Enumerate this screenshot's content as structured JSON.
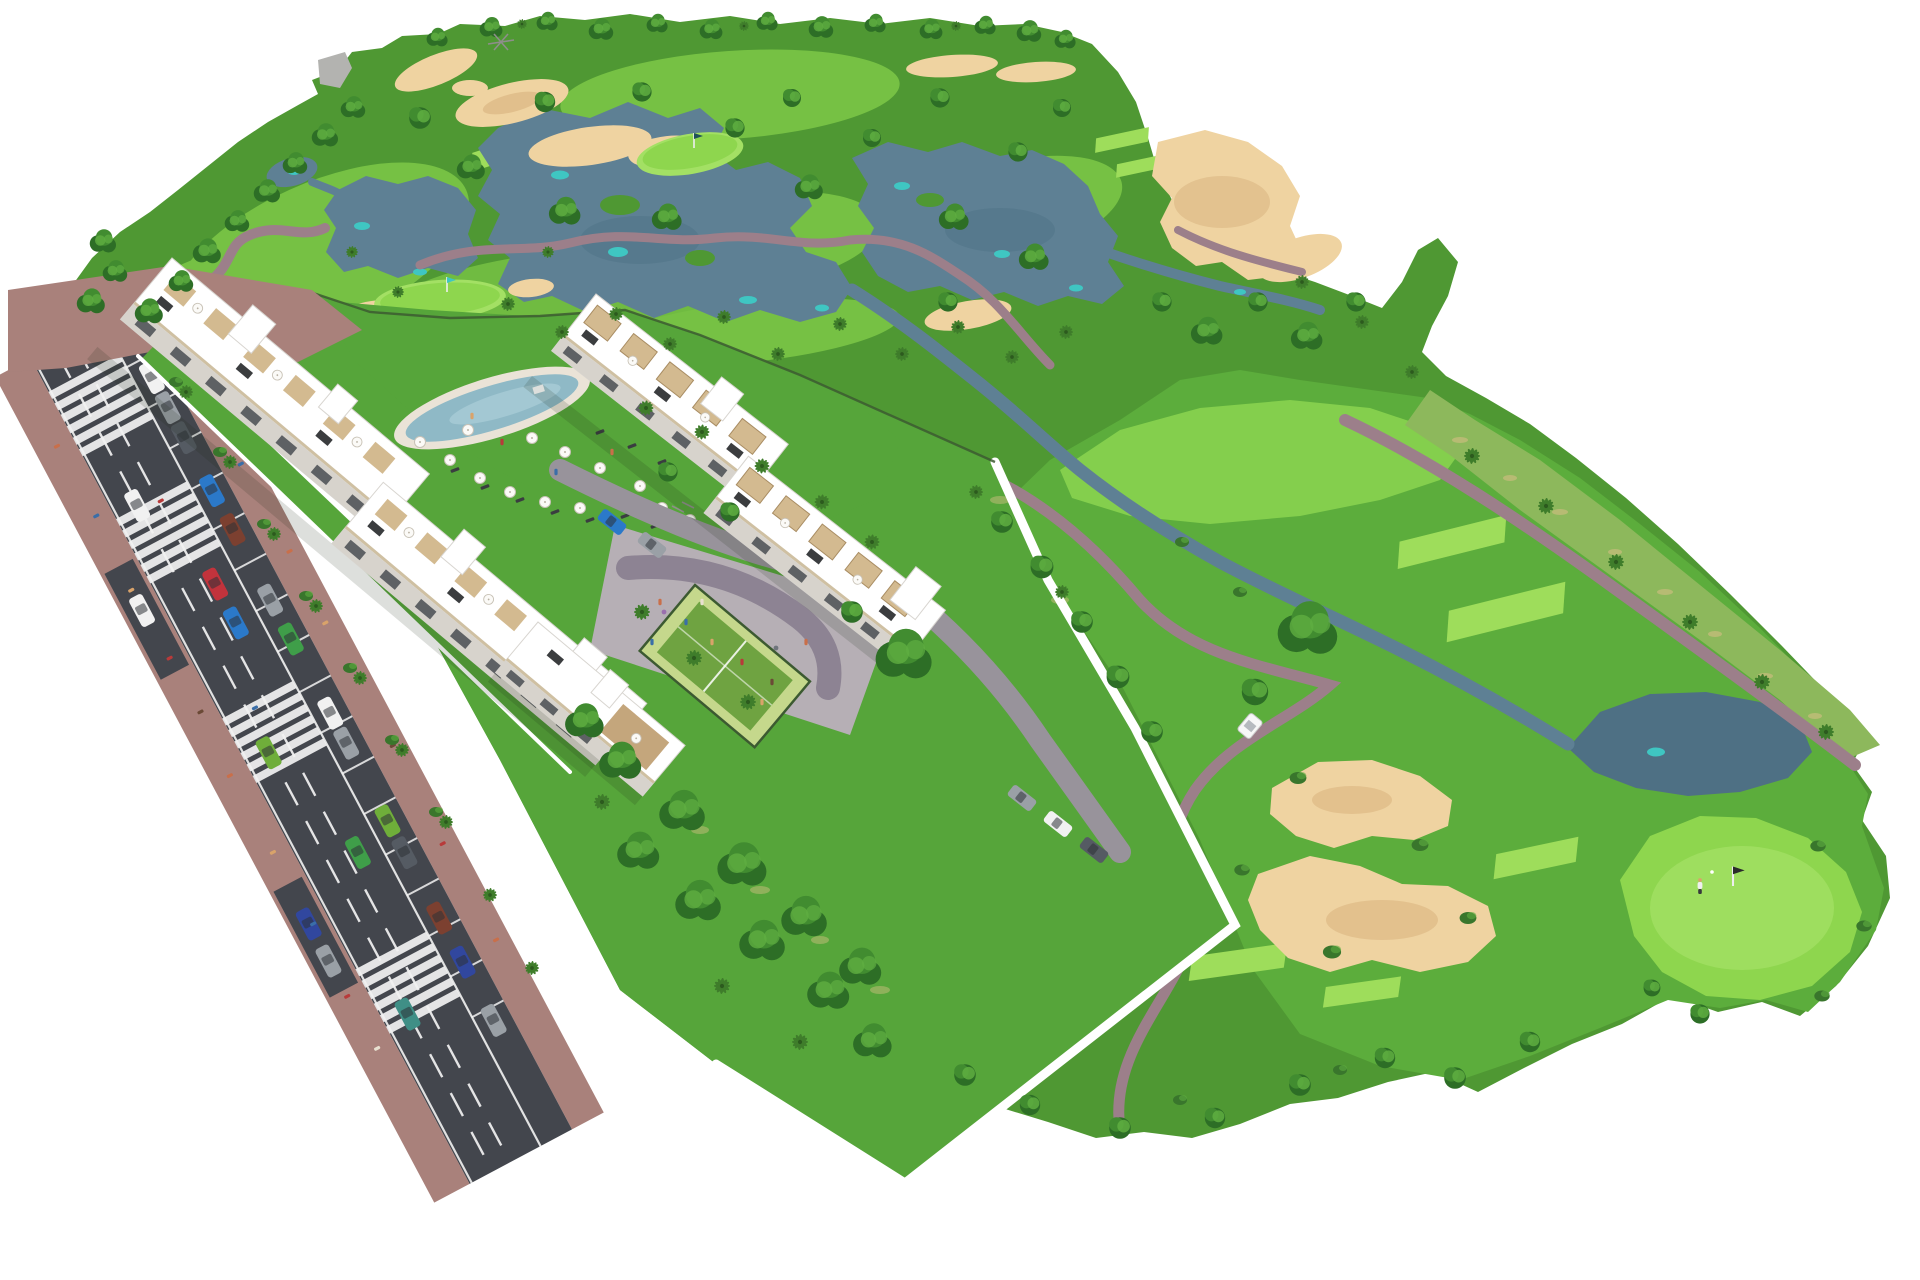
{
  "meta": {
    "title": "Golf resort residential development — aerial 3D render",
    "description": "Aerial 3D architectural rendering of a white apartment complex with swimming pool, playground plaza and padel court, beside a golf course with fairways, lakes, sand bunkers, cart paths and palm trees; a two-lane road with parked cars and pedestrians runs along the left.",
    "visible_text": "none"
  },
  "render": {
    "width": 1920,
    "height": 1280
  },
  "palette": {
    "bg": "#ffffff",
    "rough": "#4f9833",
    "mid": "#5cad3c",
    "lawn": "#56a53a",
    "fair": "#76c144",
    "fairBright": "#84cf4d",
    "tee": "#9edd5b",
    "green": "#8ed64e",
    "greenLight": "#a3e064",
    "scrub": "#8db85c",
    "speckle": "#c9bd7d",
    "lake": "#5e8094",
    "lakeDark": "#4e7084",
    "teal": "#3fc6c2",
    "sand": "#efd3a1",
    "sandDark": "#dbb783",
    "path": "#9c7f8a",
    "road": "#43464d",
    "roadLine": "#f2f2f2",
    "sidewalk": "#a9817b",
    "plaza": "#b6afb5",
    "plazaPath": "#8d8393",
    "drive": "#98939b",
    "wall": "#ffffff",
    "fence": "#3c5a31",
    "bldg": "#ffffff",
    "bldgEdge": "#d8d5d0",
    "face": "#d7d3cc",
    "window": "#41454b",
    "beige": "#cfc0a2",
    "pergola": "#d3ba90",
    "deck": "#c4a67c",
    "panel": "#26282a",
    "poolDeck": "#eae3d7",
    "water": "#8fb9c6",
    "waterLight": "#abcfd9",
    "courtOuter": "#c5d88c",
    "courtInner": "#6fa341",
    "treeDark": "#2d6e26",
    "treeMid": "#418c30",
    "treeLight": "#5fae41",
    "palm": "#3f7d2b",
    "palmDark": "#2c5a1e",
    "bush": "#39762c",
    "gray": "#b3b3b0",
    "grayDark": "#8e8e8b",
    "shadow": "#1c2a14",
    "cart": "#f7f7f7",
    "cars": {
      "red": "#c2333c",
      "blue": "#2b79c9",
      "green": "#3f9e49",
      "white": "#f1f1f1",
      "silver": "#9aa0a6",
      "dark": "#555b63",
      "navy": "#31479e",
      "maroon": "#7c4030",
      "lime": "#6fae3a",
      "teal": "#3f8f86"
    },
    "people": {
      "p1": "#c96f4a",
      "p2": "#3a6ea8",
      "p3": "#d9a36a",
      "p4": "#b83a3a",
      "p5": "#6b4a36",
      "p6": "#e8e0d0"
    }
  },
  "scene": {
    "features": [
      {
        "id": "golf-course",
        "label": "18-hole golf course with fairways, tee boxes, lakes and bunkers"
      },
      {
        "id": "apartment-row-1",
        "label": "White apartment block with rooftop terraces facing the road"
      },
      {
        "id": "apartment-row-2",
        "label": "Stepped townhouse row with pergola roof terraces"
      },
      {
        "id": "apartment-row-3",
        "label": "Small garden apartment block"
      },
      {
        "id": "swimming-pool-area",
        "label": "Lagoon pool with umbrellas and sun loungers"
      },
      {
        "id": "playground-plaza",
        "label": "Paved plaza with playground and outdoor gym"
      },
      {
        "id": "padel-court",
        "label": "Fenced padel court"
      },
      {
        "id": "main-road",
        "label": "Two-lane road with parking, crosswalks and pedestrians"
      },
      {
        "id": "golf-cart",
        "label": "Golf cart on buggy path"
      },
      {
        "id": "golfer",
        "label": "Golfer putting on the green by the flag"
      }
    ]
  }
}
